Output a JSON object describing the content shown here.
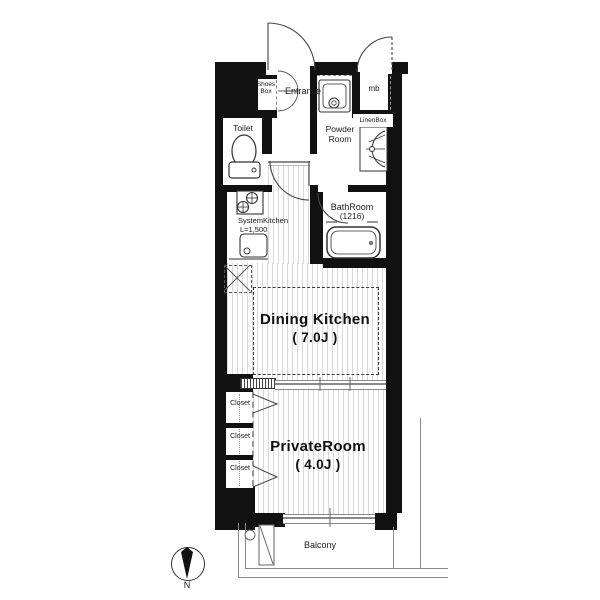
{
  "rooms": {
    "entrance": {
      "label": "Entrance"
    },
    "toilet": {
      "label": "Toilet"
    },
    "powder_room": {
      "line1": "Powder",
      "line2": "Room"
    },
    "bathroom": {
      "label": "BathRoom",
      "size": "(1216)"
    },
    "dining_kitchen": {
      "label": "Dining Kitchen",
      "size": "( 7.0J )"
    },
    "private_room": {
      "label": "PrivateRoom",
      "size": "( 4.0J )"
    },
    "balcony": {
      "label": "Balcony"
    }
  },
  "fixtures": {
    "shoes_box": {
      "line1": "Shoes",
      "line2": "Box"
    },
    "system_kitchen": {
      "line1": "SystemKitchen",
      "line2": "L=1,500"
    },
    "linen_box": {
      "label": "LinenBox"
    },
    "meter_box": {
      "label": "mb"
    },
    "closets": [
      "Closet",
      "Closet",
      "Closet"
    ]
  },
  "compass": {
    "label": "N"
  },
  "colors": {
    "wall": "#111111",
    "floor_stripe": "#d9d9d9",
    "outline": "#444444"
  }
}
